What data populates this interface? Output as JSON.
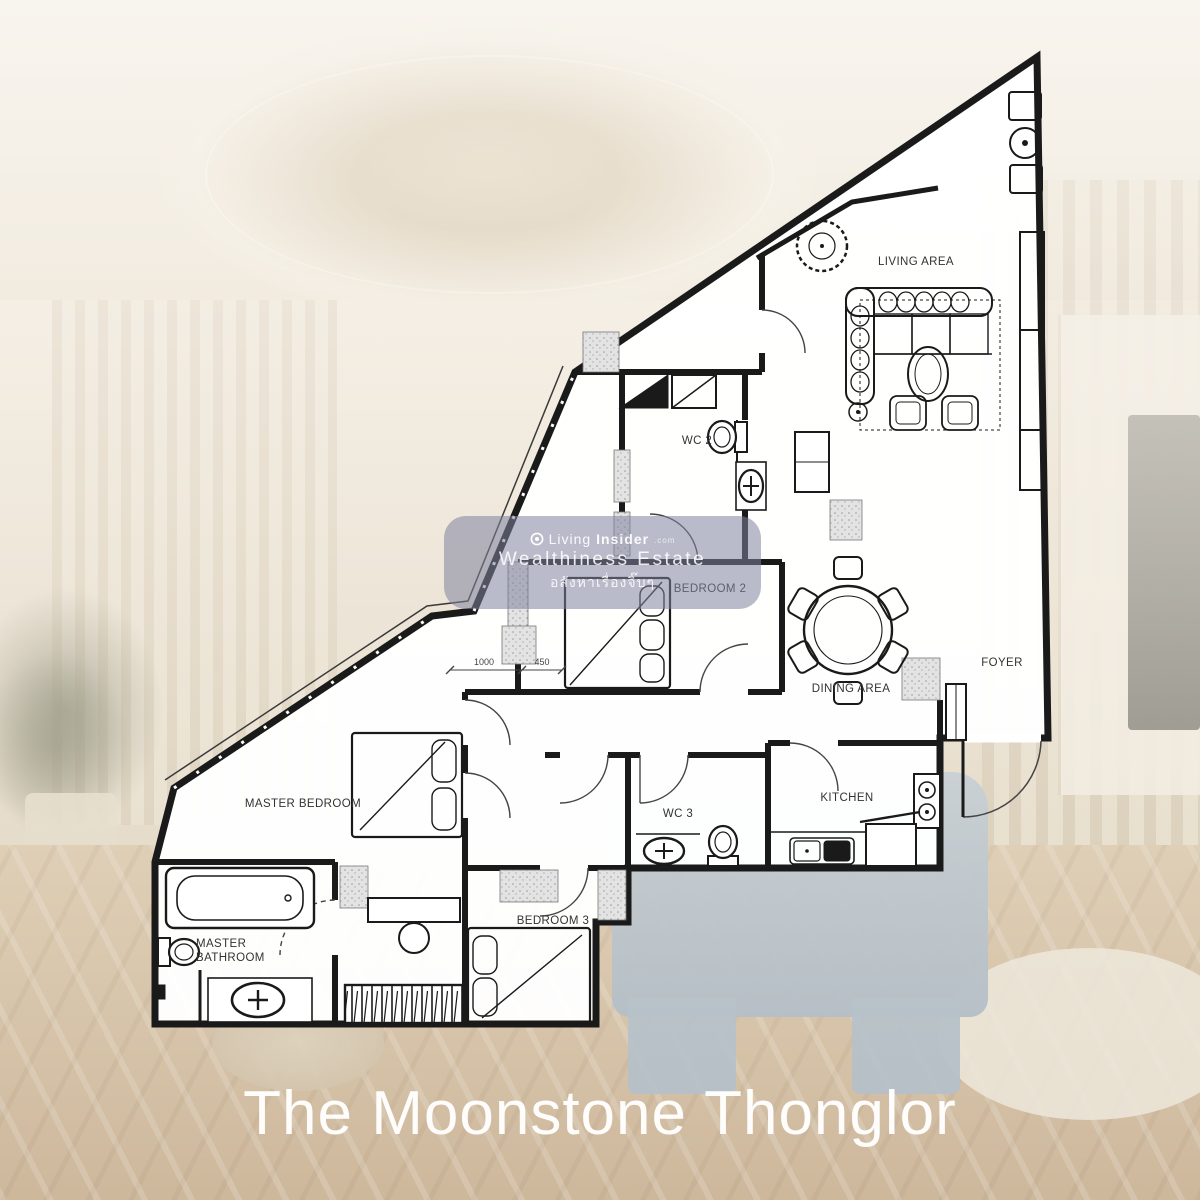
{
  "title": "The Moonstone Thonglor",
  "watermark": {
    "brand_prefix": "Living",
    "brand_bold": "Insider",
    "brand_tld": ".com",
    "line2": "Wealthiness Estate",
    "line3": "อสังหาเรื่องจิ๊บๆ"
  },
  "floorplan": {
    "rooms": {
      "living_area": "LIVING AREA",
      "wc2": "WC 2",
      "bedroom2": "BEDROOM 2",
      "dining_area": "DINING AREA",
      "foyer": "FOYER",
      "master_bedroom": "MASTER BEDROOM",
      "wc3": "WC 3",
      "kitchen": "KITCHEN",
      "bedroom3": "BEDROOM 3",
      "master_bathroom_line1": "MASTER",
      "master_bathroom_line2": "BATHROOM"
    },
    "dimensions": {
      "d1": "1000",
      "d2": "450"
    }
  },
  "colors": {
    "plan_line": "#1a1a1a",
    "plan_fill": "#ffffff",
    "watermark_bg": "rgba(128,132,158,0.55)",
    "title_color": "#ffffff"
  }
}
